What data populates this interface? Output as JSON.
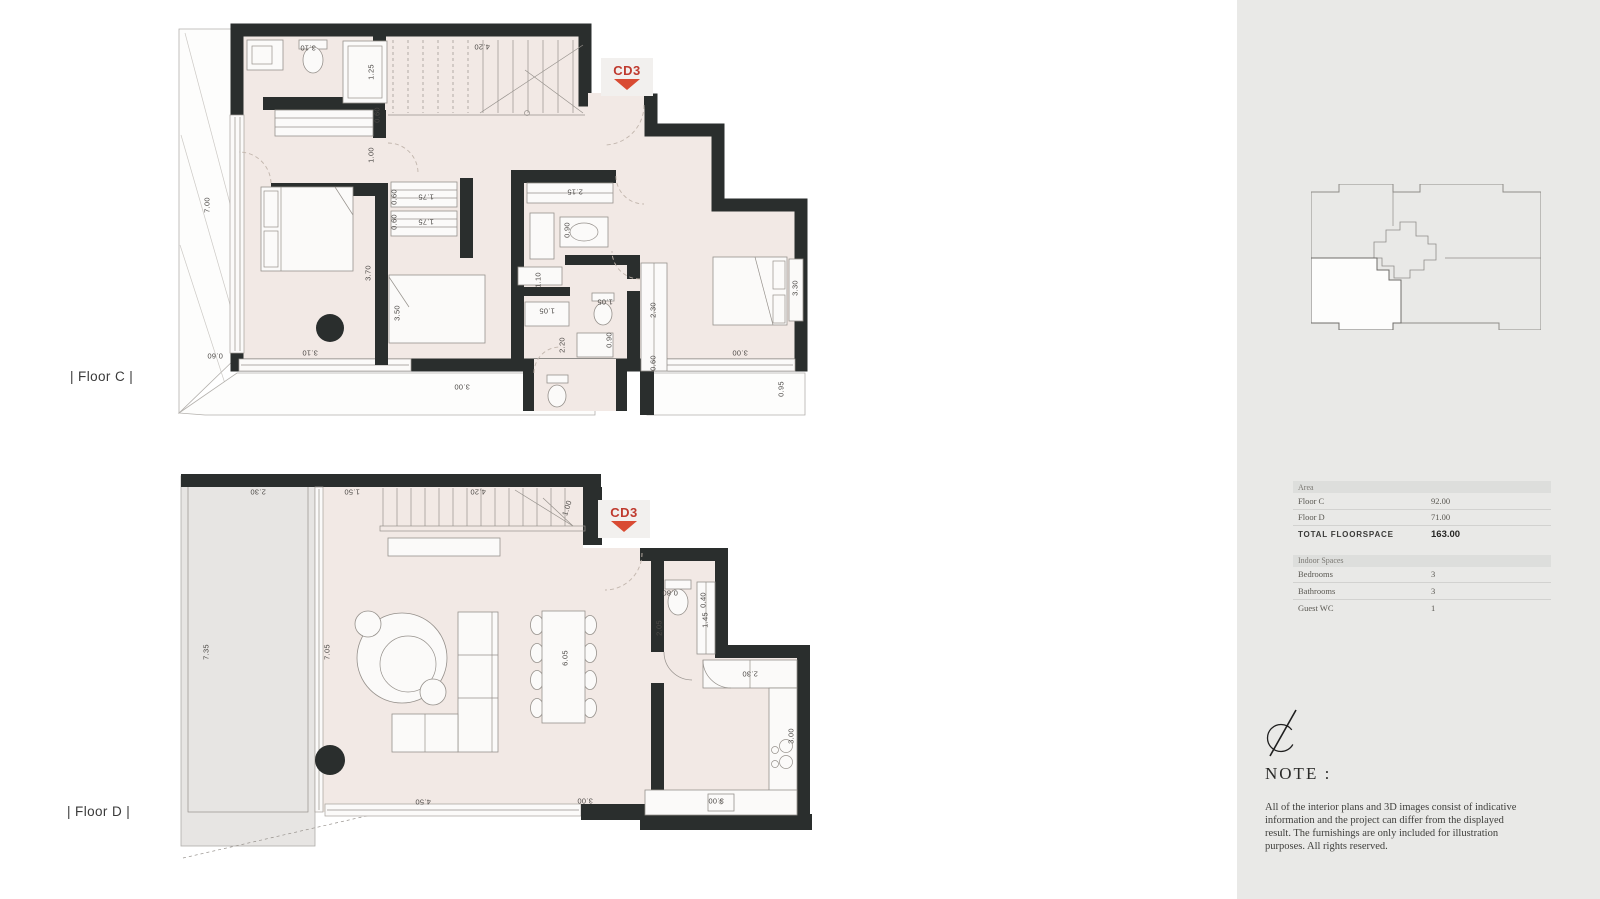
{
  "colors": {
    "wall": "#2a2e2d",
    "floor_fill": "#f2e9e5",
    "accent_red": "#bf3a2e",
    "triangle_red": "#d94b33",
    "sidebar_bg": "#e9e9e7"
  },
  "floor_c": {
    "label": "| Floor C |",
    "marker": "CD3",
    "dimensions": [
      {
        "t": "3.10",
        "x": 133,
        "y": 33,
        "r": 180
      },
      {
        "t": "1.25",
        "x": 196,
        "y": 57,
        "r": -90
      },
      {
        "t": "4.20",
        "x": 307,
        "y": 32,
        "r": 180
      },
      {
        "t": "0.60",
        "x": 202,
        "y": 100,
        "r": -90
      },
      {
        "t": "1.00",
        "x": 196,
        "y": 140,
        "r": -90
      },
      {
        "t": "7.00",
        "x": 32,
        "y": 190,
        "r": -90
      },
      {
        "t": "0.60",
        "x": 219,
        "y": 182,
        "r": -90
      },
      {
        "t": "1.75",
        "x": 251,
        "y": 182,
        "r": 180
      },
      {
        "t": "0.60",
        "x": 219,
        "y": 207,
        "r": -90
      },
      {
        "t": "1.75",
        "x": 251,
        "y": 207,
        "r": 180
      },
      {
        "t": "2.15",
        "x": 400,
        "y": 177,
        "r": 180
      },
      {
        "t": "0.90",
        "x": 392,
        "y": 215,
        "r": -90
      },
      {
        "t": "1.10",
        "x": 363,
        "y": 265,
        "r": -90
      },
      {
        "t": "3.70",
        "x": 193,
        "y": 258,
        "r": -90
      },
      {
        "t": "3.50",
        "x": 222,
        "y": 298,
        "r": -90
      },
      {
        "t": "1.05",
        "x": 372,
        "y": 296,
        "r": 180
      },
      {
        "t": "1.05",
        "x": 430,
        "y": 287,
        "r": 180
      },
      {
        "t": "0.90",
        "x": 434,
        "y": 325,
        "r": -90
      },
      {
        "t": "2.30",
        "x": 478,
        "y": 295,
        "r": -90
      },
      {
        "t": "2.20",
        "x": 387,
        "y": 330,
        "r": -90
      },
      {
        "t": "0.60",
        "x": 478,
        "y": 348,
        "r": -90
      },
      {
        "t": "3.30",
        "x": 620,
        "y": 273,
        "r": -90
      },
      {
        "t": "0.60",
        "x": 40,
        "y": 341,
        "r": 180
      },
      {
        "t": "3.10",
        "x": 135,
        "y": 338,
        "r": 180
      },
      {
        "t": "3.00",
        "x": 287,
        "y": 372,
        "r": 180
      },
      {
        "t": "3.00",
        "x": 565,
        "y": 338,
        "r": 180
      },
      {
        "t": "0.95",
        "x": 606,
        "y": 374,
        "r": -90
      }
    ]
  },
  "floor_d": {
    "label": "| Floor D |",
    "marker": "CD3",
    "dimensions": [
      {
        "t": "2.30",
        "x": 83,
        "y": 32,
        "r": 180
      },
      {
        "t": "1.50",
        "x": 177,
        "y": 32,
        "r": 180
      },
      {
        "t": "4.20",
        "x": 303,
        "y": 32,
        "r": 180
      },
      {
        "t": "1.00",
        "x": 392,
        "y": 48,
        "r": -72
      },
      {
        "t": "7.35",
        "x": 31,
        "y": 192,
        "r": -90
      },
      {
        "t": "7.05",
        "x": 152,
        "y": 192,
        "r": -90
      },
      {
        "t": "6.05",
        "x": 390,
        "y": 198,
        "r": -90
      },
      {
        "t": "0.80",
        "x": 495,
        "y": 133,
        "r": 180
      },
      {
        "t": "0.40",
        "x": 528,
        "y": 140,
        "r": -90
      },
      {
        "t": "1.45",
        "x": 530,
        "y": 160,
        "r": -90
      },
      {
        "t": "2.05",
        "x": 484,
        "y": 168,
        "r": -90
      },
      {
        "t": "2.30",
        "x": 575,
        "y": 214,
        "r": 180
      },
      {
        "t": "3.00",
        "x": 616,
        "y": 276,
        "r": -90
      },
      {
        "t": "4.50",
        "x": 248,
        "y": 342,
        "r": 180
      },
      {
        "t": "3.00",
        "x": 410,
        "y": 341,
        "r": 180
      },
      {
        "t": "3.00",
        "x": 541,
        "y": 341,
        "r": 180
      }
    ]
  },
  "sidebar": {
    "area_table": {
      "header": "Area",
      "rows": [
        {
          "label": "Floor C",
          "value": "92.00"
        },
        {
          "label": "Floor D",
          "value": "71.00"
        }
      ],
      "total_label": "TOTAL FLOORSPACE",
      "total_value": "163.00"
    },
    "spaces_table": {
      "header": "Indoor Spaces",
      "rows": [
        {
          "label": "Bedrooms",
          "value": "3"
        },
        {
          "label": "Bathrooms",
          "value": "3"
        },
        {
          "label": "Guest WC",
          "value": "1"
        }
      ]
    },
    "note": {
      "title": "NOTE :",
      "body": "All of the interior plans and 3D images consist of indicative information and the project can differ from the displayed result. The furnishings are only included for illustration purposes. All rights reserved."
    }
  }
}
